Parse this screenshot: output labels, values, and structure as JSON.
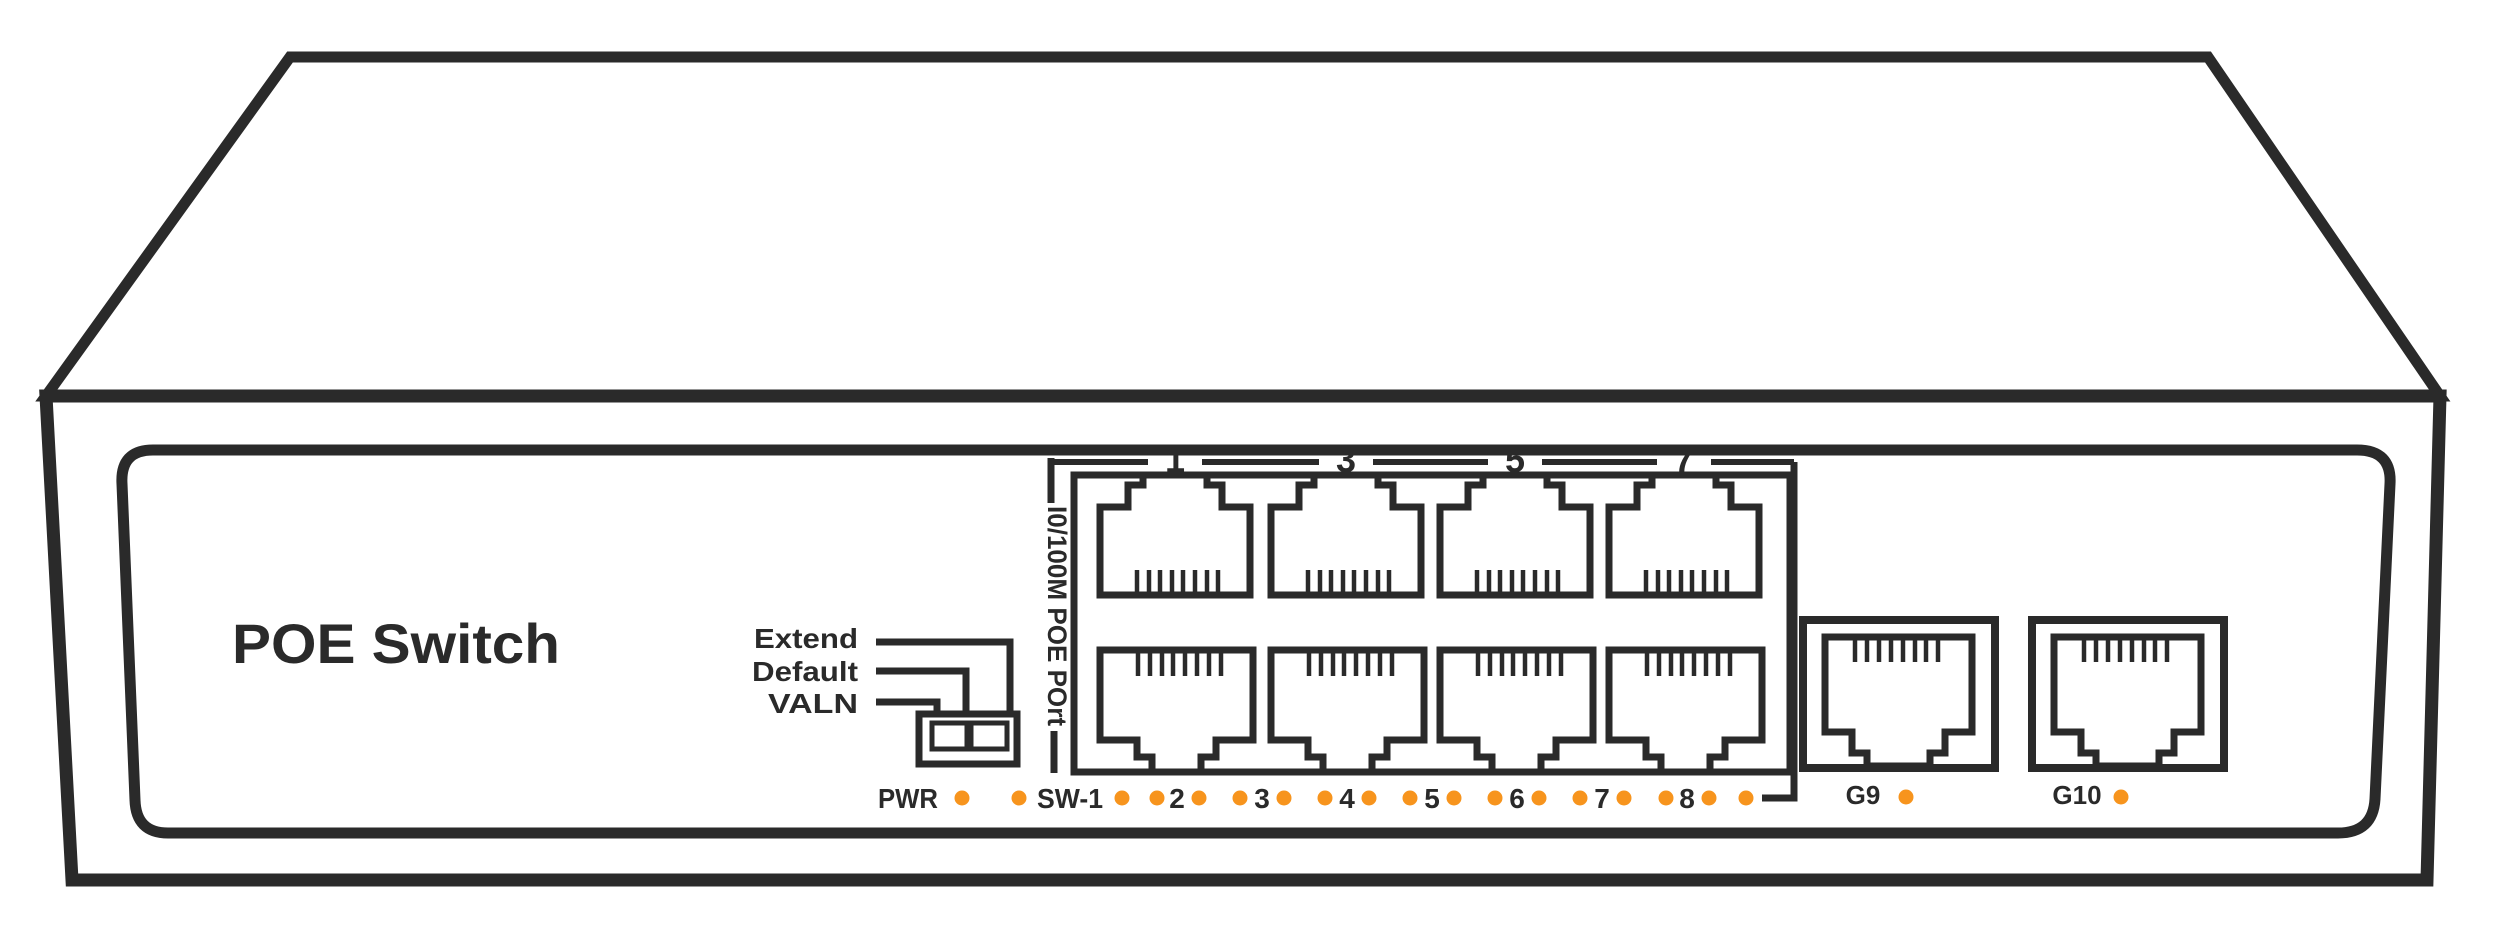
{
  "title": "POE  Switch",
  "colors": {
    "line": "#2a2a2a",
    "led": "#f7941d",
    "background": "#ffffff"
  },
  "reset_switch": {
    "labels": [
      "Extend",
      "Default",
      "VALN"
    ],
    "positions": 2
  },
  "poe_ports": {
    "group_label": "I0/100M POE POrt",
    "top_row_numbers": [
      "1",
      "3",
      "5",
      "7"
    ],
    "count": 8
  },
  "led_row": {
    "items": [
      {
        "type": "text",
        "label": "PWR",
        "x": 908
      },
      {
        "type": "led",
        "x": 962
      },
      {
        "type": "led",
        "x": 1019
      },
      {
        "type": "text",
        "label": "SW-1",
        "x": 1070
      },
      {
        "type": "led",
        "x": 1122
      },
      {
        "type": "led",
        "x": 1157
      },
      {
        "type": "text",
        "label": "2",
        "x": 1177
      },
      {
        "type": "led",
        "x": 1199
      },
      {
        "type": "led",
        "x": 1240
      },
      {
        "type": "text",
        "label": "3",
        "x": 1262
      },
      {
        "type": "led",
        "x": 1284
      },
      {
        "type": "led",
        "x": 1325
      },
      {
        "type": "text",
        "label": "4",
        "x": 1347
      },
      {
        "type": "led",
        "x": 1369
      },
      {
        "type": "led",
        "x": 1410
      },
      {
        "type": "text",
        "label": "5",
        "x": 1432
      },
      {
        "type": "led",
        "x": 1454
      },
      {
        "type": "led",
        "x": 1495
      },
      {
        "type": "text",
        "label": "6",
        "x": 1517
      },
      {
        "type": "led",
        "x": 1539
      },
      {
        "type": "led",
        "x": 1580
      },
      {
        "type": "text",
        "label": "7",
        "x": 1602
      },
      {
        "type": "led",
        "x": 1624
      },
      {
        "type": "led",
        "x": 1666
      },
      {
        "type": "text",
        "label": "8",
        "x": 1687
      },
      {
        "type": "led",
        "x": 1709
      },
      {
        "type": "led",
        "x": 1746
      }
    ]
  },
  "uplink_ports": [
    {
      "label": "G9",
      "port_x": 1803,
      "label_x": 1863,
      "led_x": 1906
    },
    {
      "label": "G10",
      "port_x": 2032,
      "label_x": 2077,
      "led_x": 2121
    }
  ]
}
